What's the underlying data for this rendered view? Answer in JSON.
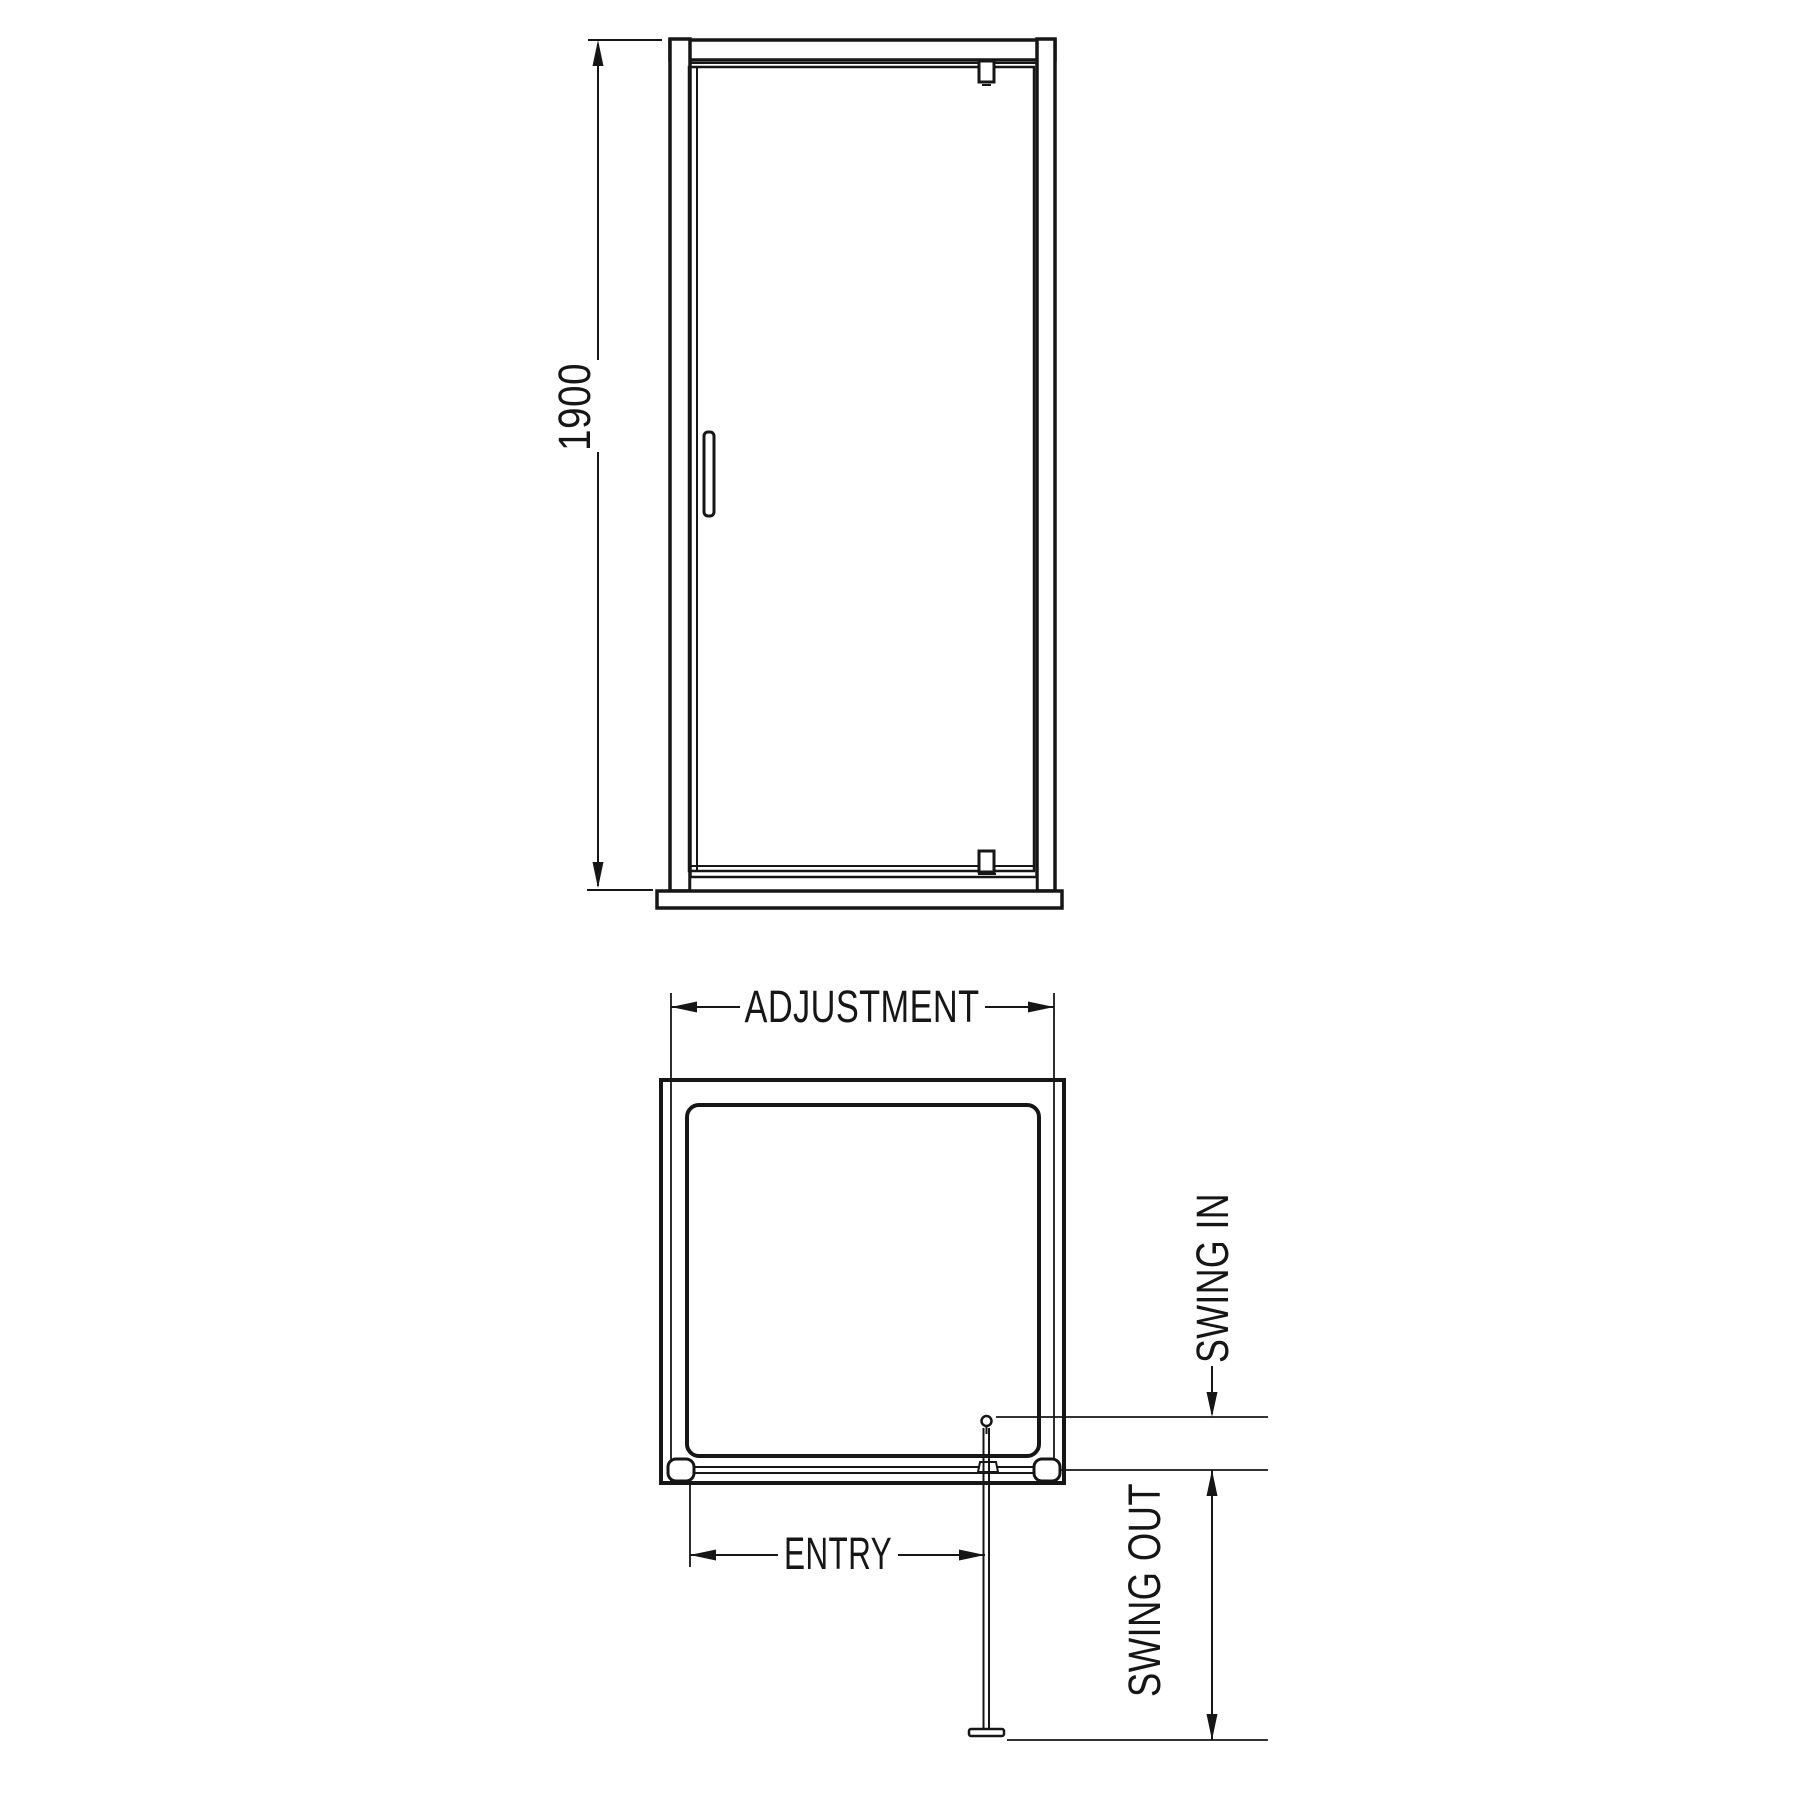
{
  "drawing": {
    "type": "shower-enclosure-pivot-door-technical-drawing",
    "colors": {
      "line": "#161616",
      "background": "#ffffff"
    },
    "front_view": {
      "height_dimension_label": "1900"
    },
    "plan_view": {
      "width_dimension_label": "ADJUSTMENT",
      "entry_dimension_label": "ENTRY",
      "swing_in_dimension_label": "SWING IN",
      "swing_out_dimension_label": "SWING OUT"
    }
  }
}
